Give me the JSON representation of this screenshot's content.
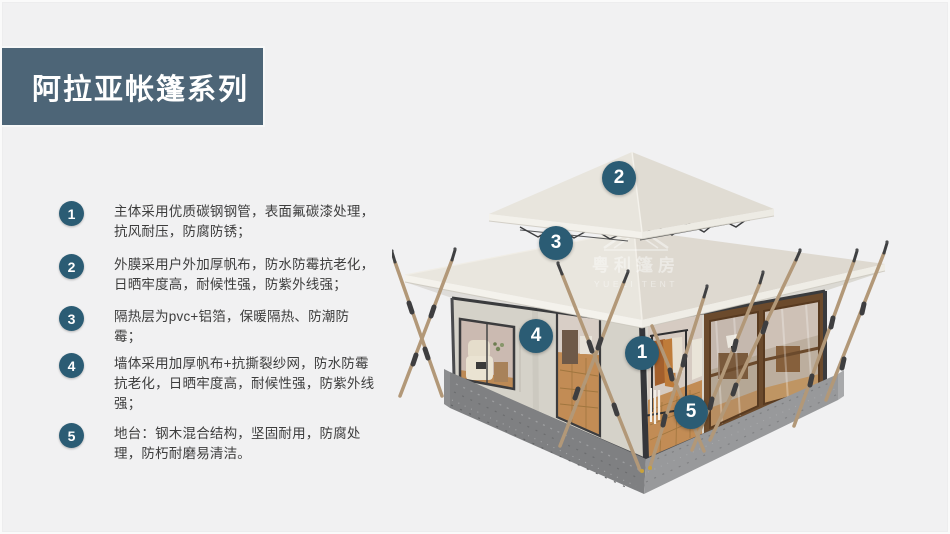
{
  "theme": {
    "background": "#f1f1f2",
    "banner": "#4d6577",
    "badge": "#2b5c74",
    "text": "#3d3d3d",
    "title_color": "#ffffff"
  },
  "header": {
    "title": "阿拉亚帐篷系列"
  },
  "features": [
    {
      "number": "1",
      "text": "主体采用优质碳钢钢管，表面氟碳漆处理，抗风耐压，防腐防锈；"
    },
    {
      "number": "2",
      "text": "外膜采用户外加厚帆布，防水防霉抗老化，日晒牢度高，耐候性强，防紫外线强；"
    },
    {
      "number": "3",
      "text": "隔热层为pvc+铝箔，保暖隔热、防潮防霉；"
    },
    {
      "number": "4",
      "text": "墙体采用加厚帆布+抗撕裂纱网，防水防霉抗老化，日晒牢度高，耐候性强，防紫外线强；"
    },
    {
      "number": "5",
      "text": "地台：钢木混合结构，坚固耐用，防腐处理，防朽耐磨易清洁。"
    }
  ],
  "tent": {
    "callouts": [
      {
        "number": "2"
      },
      {
        "number": "3"
      },
      {
        "number": "4"
      },
      {
        "number": "1"
      },
      {
        "number": "5"
      }
    ],
    "watermark": {
      "cn": "粤利篷房",
      "en": "YUELI TENT"
    },
    "illustration": "double-roof glamping tent 3d render"
  }
}
